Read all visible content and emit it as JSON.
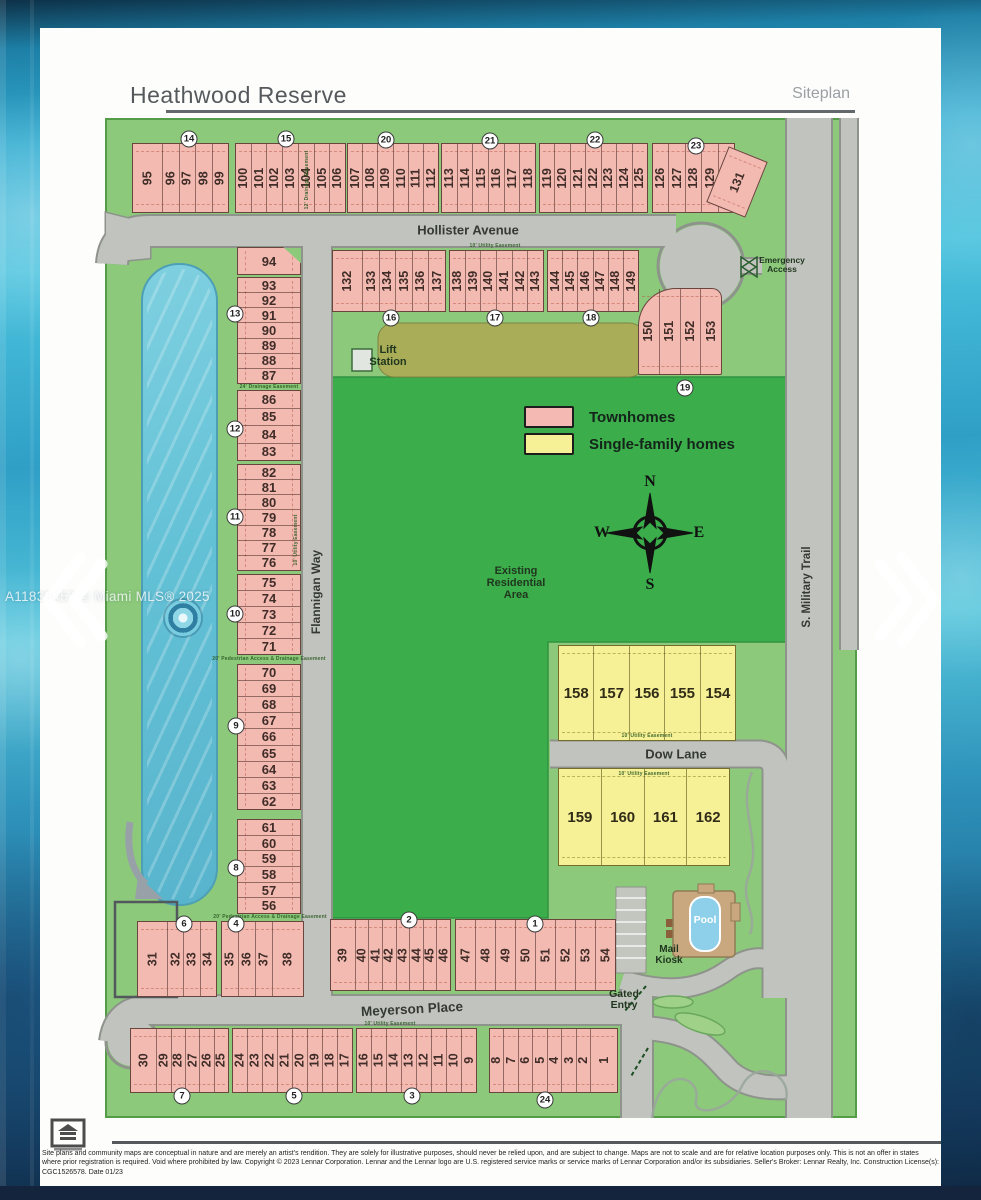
{
  "header": {
    "title": "Heathwood Reserve",
    "subtitle": "Siteplan"
  },
  "watermark": "A11833457 © Miami MLS® 2025",
  "legend": {
    "items": [
      {
        "label": "Townhomes",
        "color": "#f4b9b2"
      },
      {
        "label": "Single-family homes",
        "color": "#f6f096"
      }
    ]
  },
  "compass": {
    "n": "N",
    "e": "E",
    "s": "S",
    "w": "W"
  },
  "colors": {
    "townhome": "#f3bab2",
    "single_family": "#f6f096",
    "open_space": "#8cc97b",
    "existing_area": "#3bae4b",
    "road": "#c1c4be",
    "lake": "#6fc8da"
  },
  "siteplan": {
    "street_labels": [
      {
        "text": "Hollister Avenue",
        "x": 468,
        "y": 230,
        "rot": 0,
        "size": 13
      },
      {
        "text": "Flannigan Way",
        "x": 316,
        "y": 592,
        "rot": -90,
        "size": 12
      },
      {
        "text": "Dow Lane",
        "x": 676,
        "y": 754,
        "rot": 0,
        "size": 13
      },
      {
        "text": "Meyerson Place",
        "x": 412,
        "y": 1009,
        "rot": -3,
        "size": 13.5
      },
      {
        "text": "S. Military Trail",
        "x": 807,
        "y": 587,
        "rot": -90,
        "size": 11.5
      }
    ],
    "area_labels": [
      {
        "id": "lift-station",
        "lines": [
          "Lift",
          "Station"
        ],
        "x": 388,
        "y": 345,
        "size": 11
      },
      {
        "id": "emergency-access",
        "lines": [
          "Emergency",
          "Access"
        ],
        "x": 782,
        "y": 256,
        "size": 8.5
      },
      {
        "id": "existing-residential-area",
        "lines": [
          "Existing",
          "Residential",
          "Area"
        ],
        "x": 516,
        "y": 566,
        "size": 11
      },
      {
        "id": "pool",
        "lines": [
          "Pool"
        ],
        "x": 705,
        "y": 915,
        "size": 10.5,
        "color": "#ffffff"
      },
      {
        "id": "mail-kiosk",
        "lines": [
          "Mail",
          "Kiosk"
        ],
        "x": 669,
        "y": 945,
        "size": 10
      },
      {
        "id": "gated-entry",
        "lines": [
          "Gated",
          "Entry"
        ],
        "x": 624,
        "y": 989,
        "size": 10.5
      }
    ],
    "easement_labels": [
      {
        "text": "10' Utility Easement",
        "x": 495,
        "y": 246,
        "rot": 0
      },
      {
        "text": "12' Drainage Easement",
        "x": 307,
        "y": 180,
        "rot": -90
      },
      {
        "text": "24' Drainage Easement",
        "x": 269,
        "y": 387,
        "rot": 0
      },
      {
        "text": "10' Utility Easement",
        "x": 296,
        "y": 540,
        "rot": -90
      },
      {
        "text": "20' Pedestrian Access & Drainage Easement",
        "x": 269,
        "y": 659,
        "rot": 0
      },
      {
        "text": "20' Pedestrian Access & Drainage Easement",
        "x": 270,
        "y": 917,
        "rot": 0
      },
      {
        "text": "10' Utility Easement",
        "x": 647,
        "y": 736,
        "rot": 0
      },
      {
        "text": "10' Utility Easement",
        "x": 644,
        "y": 774,
        "rot": 0
      },
      {
        "text": "10' Utility Easement",
        "x": 390,
        "y": 1024,
        "rot": 0
      }
    ],
    "lot_blocks": [
      {
        "x": 132,
        "y": 143,
        "w": 97,
        "h": 70,
        "dir": "v",
        "wide": "first",
        "lots": [
          "95",
          "96",
          "97",
          "98",
          "99"
        ]
      },
      {
        "x": 235,
        "y": 143,
        "w": 111,
        "h": 70,
        "dir": "v",
        "lots": [
          "100",
          "101",
          "102",
          "103",
          "104",
          "105",
          "106"
        ]
      },
      {
        "x": 347,
        "y": 143,
        "w": 92,
        "h": 70,
        "dir": "v",
        "lots": [
          "107",
          "108",
          "109",
          "110",
          "111",
          "112"
        ]
      },
      {
        "x": 441,
        "y": 143,
        "w": 95,
        "h": 70,
        "dir": "v",
        "lots": [
          "113",
          "114",
          "115",
          "116",
          "117",
          "118"
        ]
      },
      {
        "x": 539,
        "y": 143,
        "w": 109,
        "h": 70,
        "dir": "v",
        "lots": [
          "119",
          "120",
          "121",
          "122",
          "123",
          "124",
          "125"
        ]
      },
      {
        "x": 652,
        "y": 143,
        "w": 83,
        "h": 70,
        "dir": "v",
        "lots": [
          "126",
          "127",
          "128",
          "129",
          "130"
        ]
      },
      {
        "x": 716,
        "y": 152,
        "w": 42,
        "h": 60,
        "dir": "v",
        "rot": 22,
        "lots": [
          "131"
        ]
      },
      {
        "x": 332,
        "y": 250,
        "w": 114,
        "h": 62,
        "dir": "v",
        "wide": "first",
        "lots": [
          "132",
          "133",
          "134",
          "135",
          "136",
          "137"
        ]
      },
      {
        "x": 449,
        "y": 250,
        "w": 95,
        "h": 62,
        "dir": "v",
        "lots": [
          "138",
          "139",
          "140",
          "141",
          "142",
          "143"
        ]
      },
      {
        "x": 547,
        "y": 250,
        "w": 92,
        "h": 62,
        "dir": "v",
        "lots": [
          "144",
          "145",
          "146",
          "147",
          "148",
          "149"
        ]
      },
      {
        "x": 638,
        "y": 288,
        "w": 84,
        "h": 87,
        "dir": "v",
        "shape": "fan",
        "lots": [
          "150",
          "151",
          "152",
          "153"
        ]
      },
      {
        "x": 237,
        "y": 247,
        "w": 64,
        "h": 28,
        "dir": "h",
        "shape": "notch",
        "lots": [
          "94"
        ]
      },
      {
        "x": 237,
        "y": 277,
        "w": 64,
        "h": 107,
        "dir": "h",
        "lots": [
          "93",
          "92",
          "91",
          "90",
          "89",
          "88",
          "87"
        ]
      },
      {
        "x": 237,
        "y": 390,
        "w": 64,
        "h": 71,
        "dir": "h",
        "lots": [
          "86",
          "85",
          "84",
          "83"
        ]
      },
      {
        "x": 237,
        "y": 464,
        "w": 64,
        "h": 107,
        "dir": "h",
        "lots": [
          "82",
          "81",
          "80",
          "79",
          "78",
          "77",
          "76"
        ]
      },
      {
        "x": 237,
        "y": 574,
        "w": 64,
        "h": 81,
        "dir": "h",
        "lots": [
          "75",
          "74",
          "73",
          "72",
          "71"
        ]
      },
      {
        "x": 237,
        "y": 664,
        "w": 64,
        "h": 146,
        "dir": "h",
        "lots": [
          "70",
          "69",
          "68",
          "67",
          "66",
          "65",
          "64",
          "63",
          "62"
        ]
      },
      {
        "x": 237,
        "y": 819,
        "w": 64,
        "h": 95,
        "dir": "h",
        "lots": [
          "61",
          "60",
          "59",
          "58",
          "57",
          "56"
        ]
      },
      {
        "x": 558,
        "y": 645,
        "w": 178,
        "h": 96,
        "dir": "hcol",
        "type": "single",
        "lots": [
          "158",
          "157",
          "156",
          "155",
          "154"
        ]
      },
      {
        "x": 558,
        "y": 768,
        "w": 172,
        "h": 98,
        "dir": "hcol",
        "type": "single",
        "lots": [
          "159",
          "160",
          "161",
          "162"
        ]
      },
      {
        "x": 137,
        "y": 921,
        "w": 80,
        "h": 76,
        "dir": "v",
        "wide": "first",
        "lots": [
          "31",
          "32",
          "33",
          "34"
        ]
      },
      {
        "x": 221,
        "y": 921,
        "w": 83,
        "h": 76,
        "dir": "v",
        "wide": "last",
        "lots": [
          "35",
          "36",
          "37",
          "38"
        ]
      },
      {
        "x": 330,
        "y": 919,
        "w": 121,
        "h": 72,
        "dir": "v",
        "wide": "first",
        "lots": [
          "39",
          "40",
          "41",
          "42",
          "43",
          "44",
          "45",
          "46"
        ]
      },
      {
        "x": 455,
        "y": 919,
        "w": 161,
        "h": 72,
        "dir": "v",
        "lots": [
          "47",
          "48",
          "49",
          "50",
          "51",
          "52",
          "53",
          "54"
        ]
      },
      {
        "x": 130,
        "y": 1028,
        "w": 99,
        "h": 65,
        "dir": "v",
        "wide": "first",
        "lots": [
          "30",
          "29",
          "28",
          "27",
          "26",
          "25"
        ]
      },
      {
        "x": 232,
        "y": 1028,
        "w": 121,
        "h": 65,
        "dir": "v",
        "lots": [
          "24",
          "23",
          "22",
          "21",
          "20",
          "19",
          "18",
          "17"
        ]
      },
      {
        "x": 356,
        "y": 1028,
        "w": 121,
        "h": 65,
        "dir": "v",
        "lots": [
          "16",
          "15",
          "14",
          "13",
          "12",
          "11",
          "10",
          "9"
        ]
      },
      {
        "x": 489,
        "y": 1028,
        "w": 129,
        "h": 65,
        "dir": "v",
        "wide": "last",
        "lots": [
          "8",
          "7",
          "6",
          "5",
          "4",
          "3",
          "2",
          "1"
        ]
      }
    ],
    "markers": [
      {
        "n": "1",
        "x": 535,
        "y": 924
      },
      {
        "n": "2",
        "x": 409,
        "y": 920
      },
      {
        "n": "3",
        "x": 412,
        "y": 1096
      },
      {
        "n": "4",
        "x": 236,
        "y": 924
      },
      {
        "n": "5",
        "x": 294,
        "y": 1096
      },
      {
        "n": "6",
        "x": 184,
        "y": 924
      },
      {
        "n": "7",
        "x": 182,
        "y": 1096
      },
      {
        "n": "8",
        "x": 236,
        "y": 868
      },
      {
        "n": "9",
        "x": 236,
        "y": 726
      },
      {
        "n": "10",
        "x": 235,
        "y": 614
      },
      {
        "n": "11",
        "x": 235,
        "y": 517
      },
      {
        "n": "12",
        "x": 235,
        "y": 429
      },
      {
        "n": "13",
        "x": 235,
        "y": 314
      },
      {
        "n": "14",
        "x": 189,
        "y": 139
      },
      {
        "n": "15",
        "x": 286,
        "y": 139
      },
      {
        "n": "16",
        "x": 391,
        "y": 318
      },
      {
        "n": "17",
        "x": 495,
        "y": 318
      },
      {
        "n": "18",
        "x": 591,
        "y": 318
      },
      {
        "n": "19",
        "x": 685,
        "y": 388
      },
      {
        "n": "20",
        "x": 386,
        "y": 140
      },
      {
        "n": "21",
        "x": 490,
        "y": 141
      },
      {
        "n": "22",
        "x": 595,
        "y": 140
      },
      {
        "n": "23",
        "x": 696,
        "y": 146
      },
      {
        "n": "24",
        "x": 545,
        "y": 1100
      }
    ]
  },
  "footer": {
    "disclaimer": "Site plans and community maps are conceptual in nature and are merely an artist's rendition. They are solely for illustrative purposes, should never be relied upon, and are subject to change. Maps are not to scale and are for relative location purposes only. This is not an offer in states where prior registration is required. Void where prohibited by law. Copyright © 2023 Lennar Corporation. Lennar and the Lennar logo are U.S. registered service marks or service marks of Lennar Corporation and/or its subsidiaries. Seller's Broker: Lennar Realty, Inc. Construction License(s): CGC1526578. Date 01/23"
  }
}
